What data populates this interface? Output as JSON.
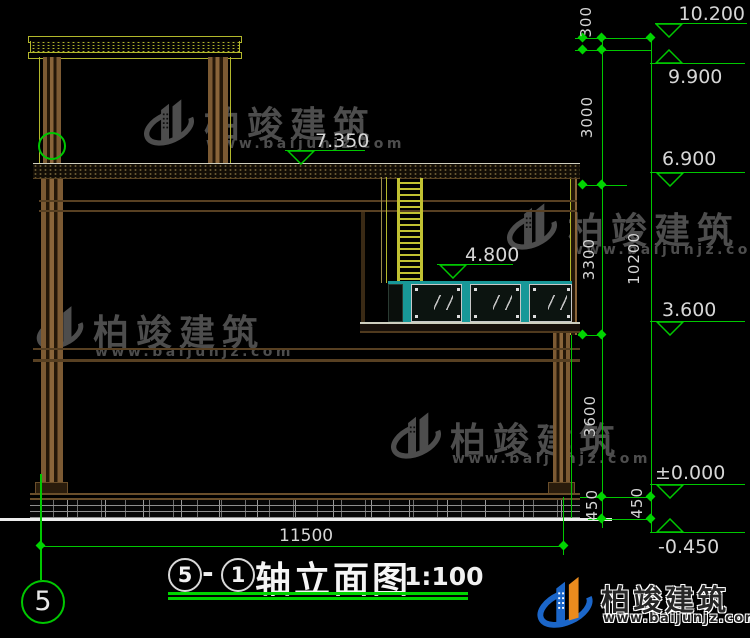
{
  "drawing_title": {
    "axis_left": "5",
    "separator": "-",
    "axis_right": "1",
    "name": "轴立面图",
    "scale": "1:100"
  },
  "axis_bubble_label": "5",
  "elevations": {
    "top_parapet": "10.200",
    "tower_roof": "9.900",
    "main_roof": "6.900",
    "roof_inner": "7.350",
    "terrace": "4.800",
    "second_floor": "3.600",
    "ground": "±0.000",
    "site": "-0.450"
  },
  "dimensions": {
    "overall_width": "11500",
    "overall_height": "10200",
    "parapet": "300",
    "tower": "3000",
    "upper": "3300",
    "lower": "3600",
    "plinth_inner": "450",
    "plinth_outer": "450"
  },
  "watermark": {
    "name": "柏竣建筑",
    "url": "www.baijunjz.com"
  },
  "footer_logo": {
    "name": "柏竣建筑",
    "url": "www.baijunjz.com"
  },
  "colors": {
    "cad_green": "#00c800",
    "roof_yellow": "#b2b72c",
    "ladder_yellow": "#c2c232",
    "frame_teal": "#189898",
    "wood_brown": "#6e4d29",
    "dim_text": "#d6d6d6",
    "watermark_gray": "#5f5f5f",
    "logo_blue": "#1b66c9",
    "logo_orange": "#ea8b1e"
  }
}
